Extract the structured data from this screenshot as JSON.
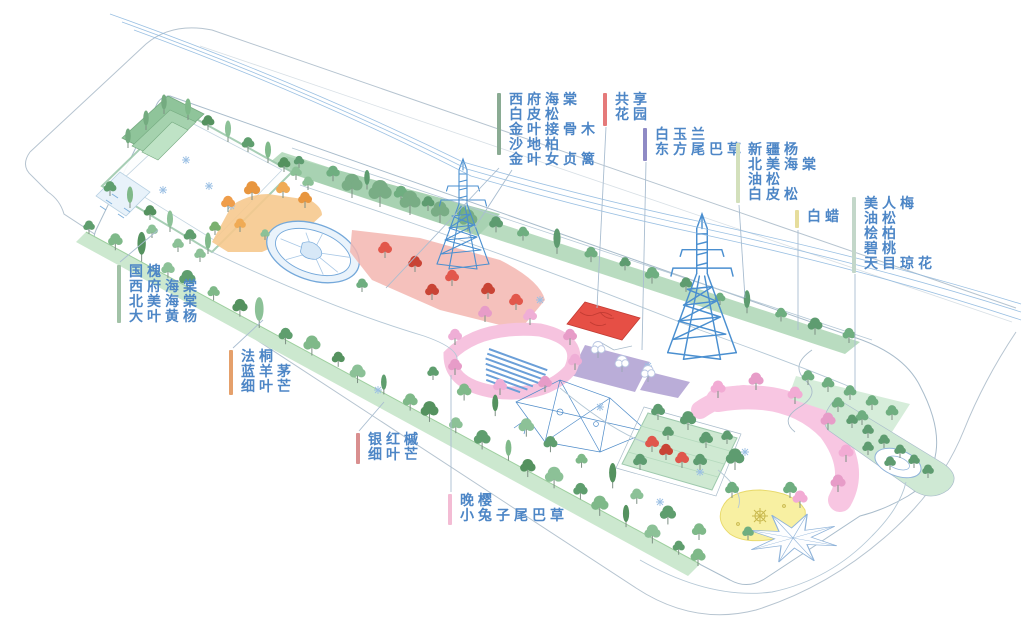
{
  "page": {
    "background": "#ffffff"
  },
  "text_color": "#4d86c6",
  "labels": [
    {
      "id": "crabapple",
      "bar_color": "#8aab93",
      "lines": [
        "西府海棠",
        "白皮松",
        "金叶接骨木",
        "沙地柏",
        "金叶女贞篱"
      ]
    },
    {
      "id": "shared-garden",
      "bar_color": "#e57a7a",
      "lines": [
        "共享",
        "花园"
      ]
    },
    {
      "id": "magnolia",
      "bar_color": "#8f8ac5",
      "lines": [
        "白玉兰",
        "东方尾巴草"
      ]
    },
    {
      "id": "poplar",
      "bar_color": "#d3e0bc",
      "lines": [
        "新疆杨",
        "北美海棠",
        "油松",
        "白皮松"
      ]
    },
    {
      "id": "ash",
      "bar_color": "#e6dd9c",
      "lines": [
        "白蜡"
      ]
    },
    {
      "id": "plum",
      "bar_color": "#c3d7c9",
      "lines": [
        "美人梅",
        "油松",
        "桧柏",
        "碧桃",
        "天目琼花"
      ]
    },
    {
      "id": "pagoda",
      "bar_color": "#a2c2a7",
      "lines": [
        "国槐",
        "西府海棠",
        "北美海棠",
        "大叶黄杨"
      ]
    },
    {
      "id": "platanus",
      "bar_color": "#e5a06b",
      "lines": [
        "法桐",
        "蓝羊茅",
        "细叶芒"
      ]
    },
    {
      "id": "maple",
      "bar_color": "#d98f8f",
      "lines": [
        "银红槭",
        "细叶芒"
      ]
    },
    {
      "id": "cherry",
      "bar_color": "#f3bcd4",
      "lines": [
        "晚樱",
        "小兔子尾巴草"
      ]
    }
  ],
  "scene": {
    "type": "axonometric-planting-plan",
    "visible_features": [
      "outer ring road",
      "entrance plaza with stepped green terraces",
      "autumn orange garden",
      "blue circular plaza",
      "red perennial zone",
      "shared-garden red flower patch",
      "purple planting beds",
      "cherry loop path with amphitheater steps",
      "blue playground structure",
      "central lawn",
      "yellow play area with star motif",
      "octagram star paving",
      "pink crescent cherry path",
      "eastern green grove",
      "two transmission towers with power lines",
      "street tree rows"
    ],
    "palette": {
      "line_blue": "#4a8fd0",
      "outline_gray": "#a9bccb",
      "tree_green": "#5f9e6e",
      "canopy_green": "#7fb287",
      "verge_green": "#cce8cf",
      "orange_zone": "#f6c98e",
      "red_zone": "#f3b6b0",
      "shared_red": "#e64f45",
      "purple_zone": "#b2a4d4",
      "cherry_pink": "#f6c3df",
      "lawn_green": "#cfe9d2",
      "yellow_zone": "#f8f0a2",
      "crescent_pink": "#f8c6e2",
      "water_blue": "#6b9fd8"
    }
  }
}
